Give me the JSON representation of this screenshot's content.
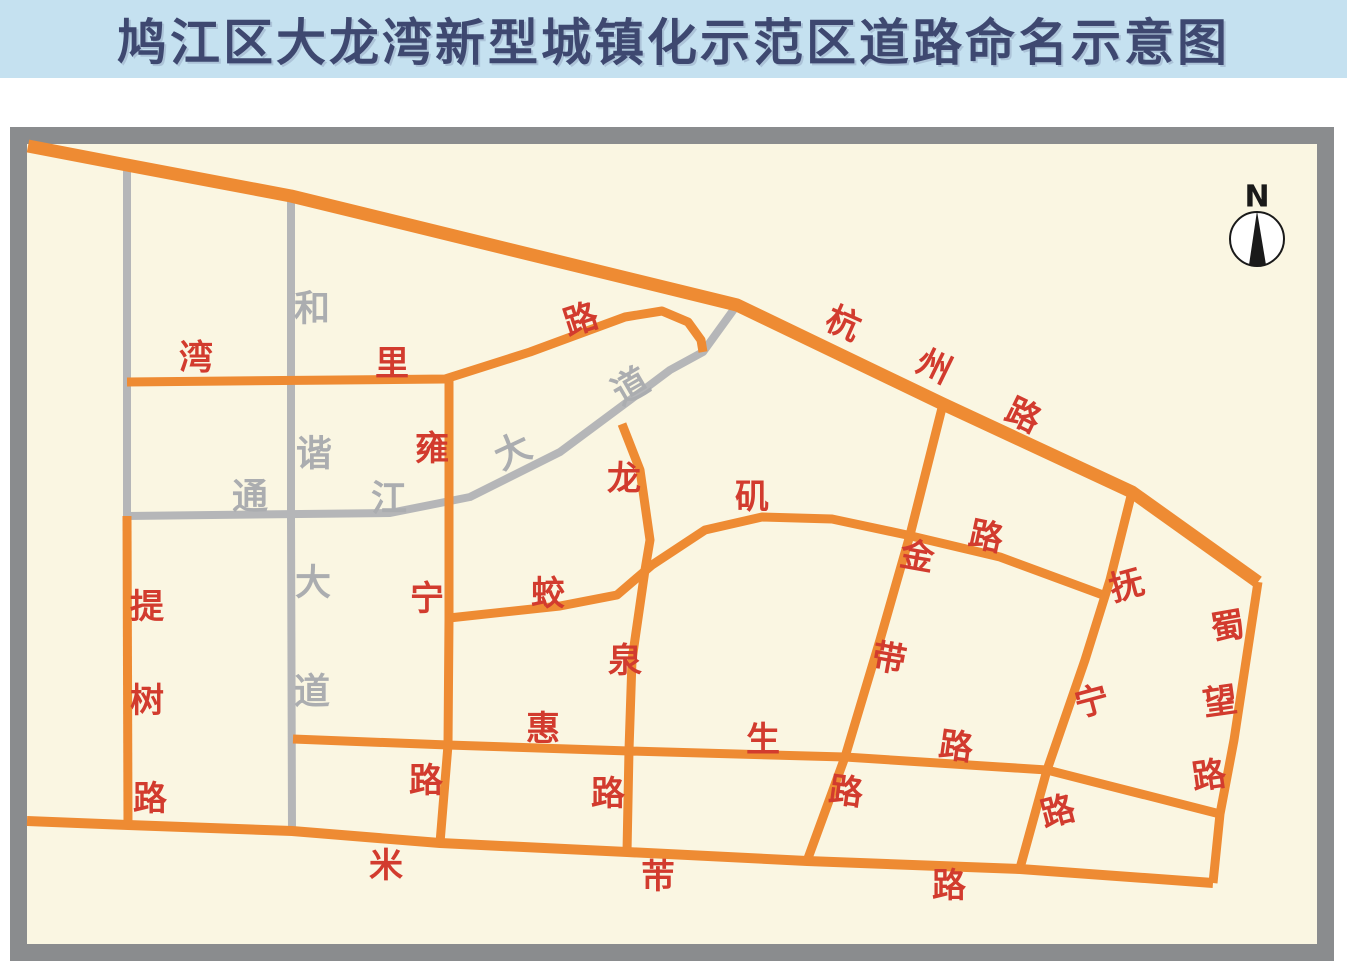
{
  "title": {
    "text": "鸠江区大龙湾新型城镇化示范区道路命名示意图"
  },
  "map": {
    "colors": {
      "cream": "#FAF6E2",
      "border": "#8A8C8E",
      "orange": "#EE8B33",
      "gray_road": "#B5B6B8",
      "red": "#D23B2E",
      "gray_text": "#ABADB0",
      "title_bg": "#C5E1F0",
      "title_fg": "#3E4870",
      "compass_ink": "#1A1A1A"
    },
    "frame": {
      "x": 18.5,
      "y": 135.5,
      "w": 1307,
      "h": 817,
      "border_w": 17
    },
    "roads": [
      {
        "id": "tongjiang-dadao",
        "name": "通江大道",
        "color": "gray",
        "width": 8,
        "points": [
          [
            127,
            516
          ],
          [
            390,
            513
          ],
          [
            470,
            497
          ],
          [
            560,
            452
          ],
          [
            630,
            400
          ],
          [
            670,
            370
          ],
          [
            703,
            352
          ],
          [
            737,
            305
          ]
        ]
      },
      {
        "id": "hexie-dadao",
        "name": "和谐大道",
        "color": "gray",
        "width": 8,
        "points": [
          [
            291,
            195
          ],
          [
            291,
            516
          ],
          [
            292,
            830
          ]
        ]
      },
      {
        "id": "west-gray-road",
        "name": "",
        "color": "gray",
        "width": 8,
        "points": [
          [
            127,
            164
          ],
          [
            127,
            516
          ]
        ]
      },
      {
        "id": "wanli-lu",
        "name": "湾里路",
        "color": "orange",
        "width": 9,
        "points": [
          [
            127,
            382
          ],
          [
            445,
            379
          ],
          [
            530,
            352
          ],
          [
            625,
            317
          ],
          [
            662,
            311
          ],
          [
            688,
            322
          ],
          [
            701,
            340
          ],
          [
            703,
            352
          ]
        ]
      },
      {
        "id": "yongning-lu",
        "name": "雍宁路",
        "color": "orange",
        "width": 9,
        "points": [
          [
            449,
            379
          ],
          [
            449,
            620
          ],
          [
            448,
            745
          ],
          [
            440,
            843
          ]
        ]
      },
      {
        "id": "longquan-lu",
        "name": "龙泉路",
        "color": "orange",
        "width": 9,
        "points": [
          [
            622,
            424
          ],
          [
            640,
            470
          ],
          [
            650,
            540
          ],
          [
            645,
            570
          ],
          [
            632,
            660
          ],
          [
            629,
            750
          ],
          [
            627,
            852
          ]
        ]
      },
      {
        "id": "jiaoji-lu",
        "name": "蛟矶路",
        "color": "orange",
        "width": 9,
        "points": [
          [
            449,
            618
          ],
          [
            560,
            606
          ],
          [
            617,
            595
          ],
          [
            652,
            565
          ],
          [
            705,
            530
          ],
          [
            762,
            517
          ],
          [
            832,
            519
          ],
          [
            907,
            535
          ],
          [
            1000,
            557
          ],
          [
            1103,
            595
          ]
        ]
      },
      {
        "id": "jindai-lu",
        "name": "金带路",
        "color": "orange",
        "width": 9,
        "points": [
          [
            943,
            404
          ],
          [
            910,
            535
          ],
          [
            880,
            640
          ],
          [
            845,
            757
          ],
          [
            807,
            861
          ]
        ]
      },
      {
        "id": "funing-lu",
        "name": "抚宁路",
        "color": "orange",
        "width": 9,
        "points": [
          [
            1132,
            492
          ],
          [
            1110,
            580
          ],
          [
            1085,
            660
          ],
          [
            1047,
            770
          ],
          [
            1020,
            868
          ]
        ]
      },
      {
        "id": "shuwang-lu",
        "name": "蜀望路",
        "color": "orange",
        "width": 9,
        "points": [
          [
            1258,
            582
          ],
          [
            1234,
            740
          ],
          [
            1220,
            814
          ],
          [
            1213,
            883
          ]
        ]
      },
      {
        "id": "huisheng-lu",
        "name": "惠生路",
        "color": "orange",
        "width": 9,
        "points": [
          [
            293,
            739
          ],
          [
            448,
            745
          ],
          [
            629,
            751
          ],
          [
            845,
            757
          ],
          [
            1047,
            770
          ],
          [
            1220,
            814
          ]
        ]
      },
      {
        "id": "mifu-lu",
        "name": "米芾路",
        "color": "orange",
        "width": 10,
        "points": [
          [
            27,
            821
          ],
          [
            128,
            825
          ],
          [
            292,
            831
          ],
          [
            440,
            843
          ],
          [
            627,
            852
          ],
          [
            807,
            861
          ],
          [
            1020,
            869
          ],
          [
            1213,
            883
          ]
        ]
      },
      {
        "id": "tishu-lu",
        "name": "提树路",
        "color": "orange",
        "width": 9,
        "points": [
          [
            127,
            516
          ],
          [
            128,
            825
          ]
        ]
      },
      {
        "id": "hangzhou-lu",
        "name": "杭州路",
        "color": "orange",
        "width": 13,
        "points": [
          [
            28,
            146
          ],
          [
            127,
            165
          ],
          [
            291,
            196
          ],
          [
            737,
            305
          ],
          [
            943,
            404
          ],
          [
            1132,
            492
          ],
          [
            1258,
            582
          ]
        ]
      }
    ],
    "labels": [
      {
        "text": "湾",
        "x": 196,
        "y": 358,
        "rot": 0,
        "color": "red",
        "road": "wanli-lu"
      },
      {
        "text": "里",
        "x": 392,
        "y": 364,
        "rot": 0,
        "color": "red",
        "road": "wanli-lu"
      },
      {
        "text": "路",
        "x": 581,
        "y": 320,
        "rot": -18,
        "color": "red",
        "road": "wanli-lu"
      },
      {
        "text": "雍",
        "x": 432,
        "y": 449,
        "rot": 0,
        "color": "red",
        "road": "yongning-lu"
      },
      {
        "text": "宁",
        "x": 427,
        "y": 599,
        "rot": 0,
        "color": "red",
        "road": "yongning-lu"
      },
      {
        "text": "路",
        "x": 426,
        "y": 781,
        "rot": 0,
        "color": "red",
        "road": "yongning-lu"
      },
      {
        "text": "龙",
        "x": 624,
        "y": 479,
        "rot": 0,
        "color": "red",
        "road": "longquan-lu"
      },
      {
        "text": "泉",
        "x": 625,
        "y": 661,
        "rot": 0,
        "color": "red",
        "road": "longquan-lu"
      },
      {
        "text": "路",
        "x": 608,
        "y": 794,
        "rot": 0,
        "color": "red",
        "road": "longquan-lu"
      },
      {
        "text": "蛟",
        "x": 548,
        "y": 594,
        "rot": 0,
        "color": "red",
        "road": "jiaoji-lu"
      },
      {
        "text": "矶",
        "x": 752,
        "y": 497,
        "rot": 0,
        "color": "red",
        "road": "jiaoji-lu"
      },
      {
        "text": "路",
        "x": 986,
        "y": 537,
        "rot": 12,
        "color": "red",
        "road": "jiaoji-lu"
      },
      {
        "text": "杭",
        "x": 843,
        "y": 324,
        "rot": 24,
        "color": "red",
        "road": "hangzhou-lu"
      },
      {
        "text": "州",
        "x": 934,
        "y": 367,
        "rot": 26,
        "color": "red",
        "road": "hangzhou-lu"
      },
      {
        "text": "路",
        "x": 1023,
        "y": 416,
        "rot": 26,
        "color": "red",
        "road": "hangzhou-lu"
      },
      {
        "text": "金",
        "x": 917,
        "y": 557,
        "rot": 10,
        "color": "red",
        "road": "jindai-lu"
      },
      {
        "text": "带",
        "x": 889,
        "y": 659,
        "rot": 10,
        "color": "red",
        "road": "jindai-lu"
      },
      {
        "text": "路",
        "x": 846,
        "y": 792,
        "rot": 8,
        "color": "red",
        "road": "jindai-lu"
      },
      {
        "text": "抚",
        "x": 1127,
        "y": 586,
        "rot": -15,
        "color": "red",
        "road": "funing-lu"
      },
      {
        "text": "宁",
        "x": 1092,
        "y": 702,
        "rot": -15,
        "color": "red",
        "road": "funing-lu"
      },
      {
        "text": "路",
        "x": 1058,
        "y": 812,
        "rot": -15,
        "color": "red",
        "road": "funing-lu"
      },
      {
        "text": "蜀",
        "x": 1228,
        "y": 627,
        "rot": -10,
        "color": "red",
        "road": "shuwang-lu"
      },
      {
        "text": "望",
        "x": 1220,
        "y": 702,
        "rot": -8,
        "color": "red",
        "road": "shuwang-lu"
      },
      {
        "text": "路",
        "x": 1209,
        "y": 776,
        "rot": -8,
        "color": "red",
        "road": "shuwang-lu"
      },
      {
        "text": "提",
        "x": 147,
        "y": 607,
        "rot": 0,
        "color": "red",
        "road": "tishu-lu"
      },
      {
        "text": "树",
        "x": 147,
        "y": 701,
        "rot": 0,
        "color": "red",
        "road": "tishu-lu"
      },
      {
        "text": "路",
        "x": 150,
        "y": 799,
        "rot": 0,
        "color": "red",
        "road": "tishu-lu"
      },
      {
        "text": "惠",
        "x": 543,
        "y": 729,
        "rot": 0,
        "color": "red",
        "road": "huisheng-lu"
      },
      {
        "text": "生",
        "x": 763,
        "y": 740,
        "rot": 0,
        "color": "red",
        "road": "huisheng-lu"
      },
      {
        "text": "路",
        "x": 956,
        "y": 747,
        "rot": 8,
        "color": "red",
        "road": "huisheng-lu"
      },
      {
        "text": "米",
        "x": 386,
        "y": 866,
        "rot": 0,
        "color": "red",
        "road": "mifu-lu"
      },
      {
        "text": "芾",
        "x": 658,
        "y": 877,
        "rot": 0,
        "color": "red",
        "road": "mifu-lu"
      },
      {
        "text": "路",
        "x": 949,
        "y": 886,
        "rot": 0,
        "color": "red",
        "road": "mifu-lu"
      },
      {
        "text": "和",
        "x": 312,
        "y": 309,
        "rot": 0,
        "color": "gray",
        "road": "hexie-dadao"
      },
      {
        "text": "谐",
        "x": 314,
        "y": 454,
        "rot": 0,
        "color": "gray",
        "road": "hexie-dadao"
      },
      {
        "text": "大",
        "x": 313,
        "y": 583,
        "rot": 0,
        "color": "gray",
        "road": "hexie-dadao"
      },
      {
        "text": "道",
        "x": 312,
        "y": 692,
        "rot": 0,
        "color": "gray",
        "road": "hexie-dadao"
      },
      {
        "text": "通",
        "x": 250,
        "y": 497,
        "rot": 0,
        "color": "gray",
        "road": "tongjiang-dadao"
      },
      {
        "text": "江",
        "x": 389,
        "y": 499,
        "rot": 0,
        "color": "gray",
        "road": "tongjiang-dadao"
      },
      {
        "text": "大",
        "x": 513,
        "y": 452,
        "rot": -25,
        "color": "gray",
        "road": "tongjiang-dadao"
      },
      {
        "text": "道",
        "x": 631,
        "y": 387,
        "rot": -30,
        "color": "gray",
        "road": "tongjiang-dadao"
      }
    ],
    "label_font": {
      "red_size": 34,
      "gray_size": 36
    },
    "compass": {
      "label": "N",
      "label_x": 1257,
      "label_y": 197,
      "cx": 1257,
      "cy": 239,
      "r": 27,
      "needle": [
        [
          1257,
          211
        ],
        [
          1249,
          265
        ],
        [
          1266,
          265
        ]
      ]
    }
  }
}
